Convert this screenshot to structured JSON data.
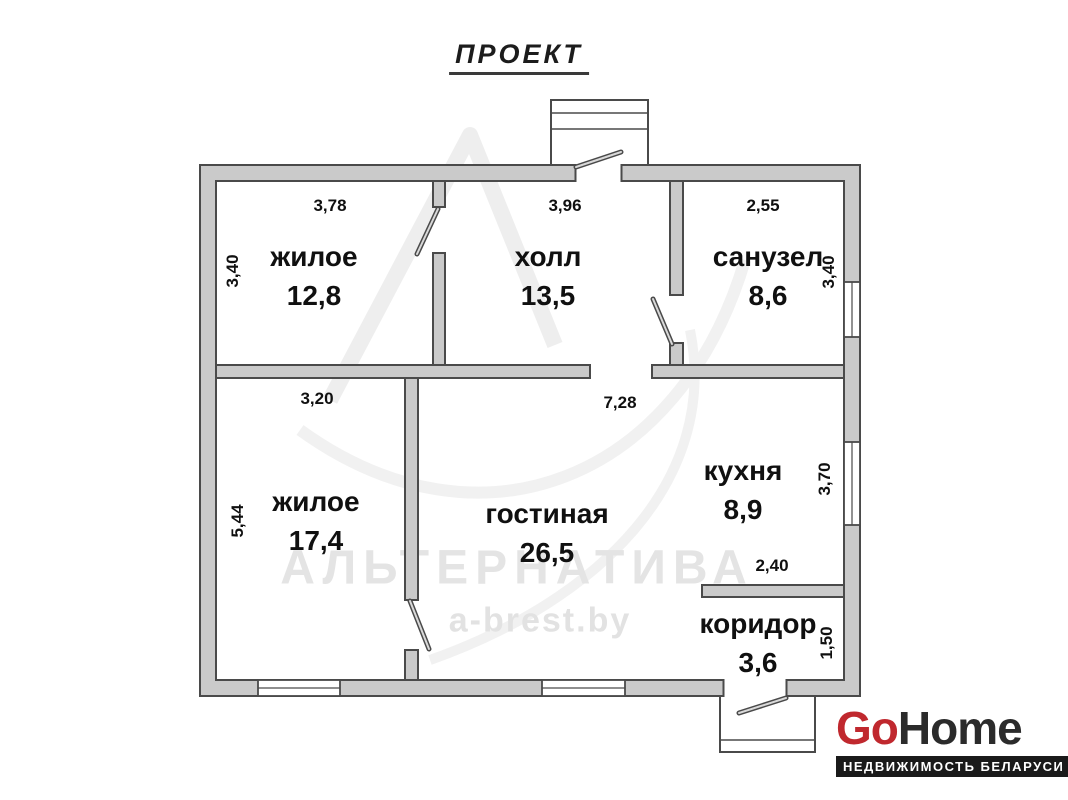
{
  "title": "ПРОЕКТ",
  "watermark": {
    "brand": "АЛЬТЕРНАТИВА",
    "site": "a-brest.by"
  },
  "rooms": {
    "living1": {
      "name": "жилое",
      "area": "12,8"
    },
    "hall": {
      "name": "холл",
      "area": "13,5"
    },
    "bathroom": {
      "name": "санузел",
      "area": "8,6"
    },
    "living2": {
      "name": "жилое",
      "area": "17,4"
    },
    "lounge": {
      "name": "гостиная",
      "area": "26,5"
    },
    "kitchen": {
      "name": "кухня",
      "area": "8,9"
    },
    "corridor": {
      "name": "коридор",
      "area": "3,6"
    }
  },
  "dimensions": {
    "top_living1": "3,78",
    "top_hall": "3,96",
    "top_bathroom": "2,55",
    "left_living1": "3,40",
    "right_bathroom": "3,40",
    "mid_living2": "3,20",
    "mid_lounge": "7,28",
    "left_living2": "5,44",
    "right_kitchen": "3,70",
    "kitchen_width": "2,40",
    "right_corridor": "1,50"
  },
  "logo": {
    "brand_red": "Go",
    "brand_dark": "Home",
    "tagline": "НЕДВИЖИМОСТЬ БЕЛАРУСИ"
  },
  "colors": {
    "wall_fill": "#cacaca",
    "wall_line": "#4a4a4a",
    "watermark": "#e4e4e4",
    "logo_accent": "#c0282e",
    "logo_dark": "#2b2b2b"
  }
}
